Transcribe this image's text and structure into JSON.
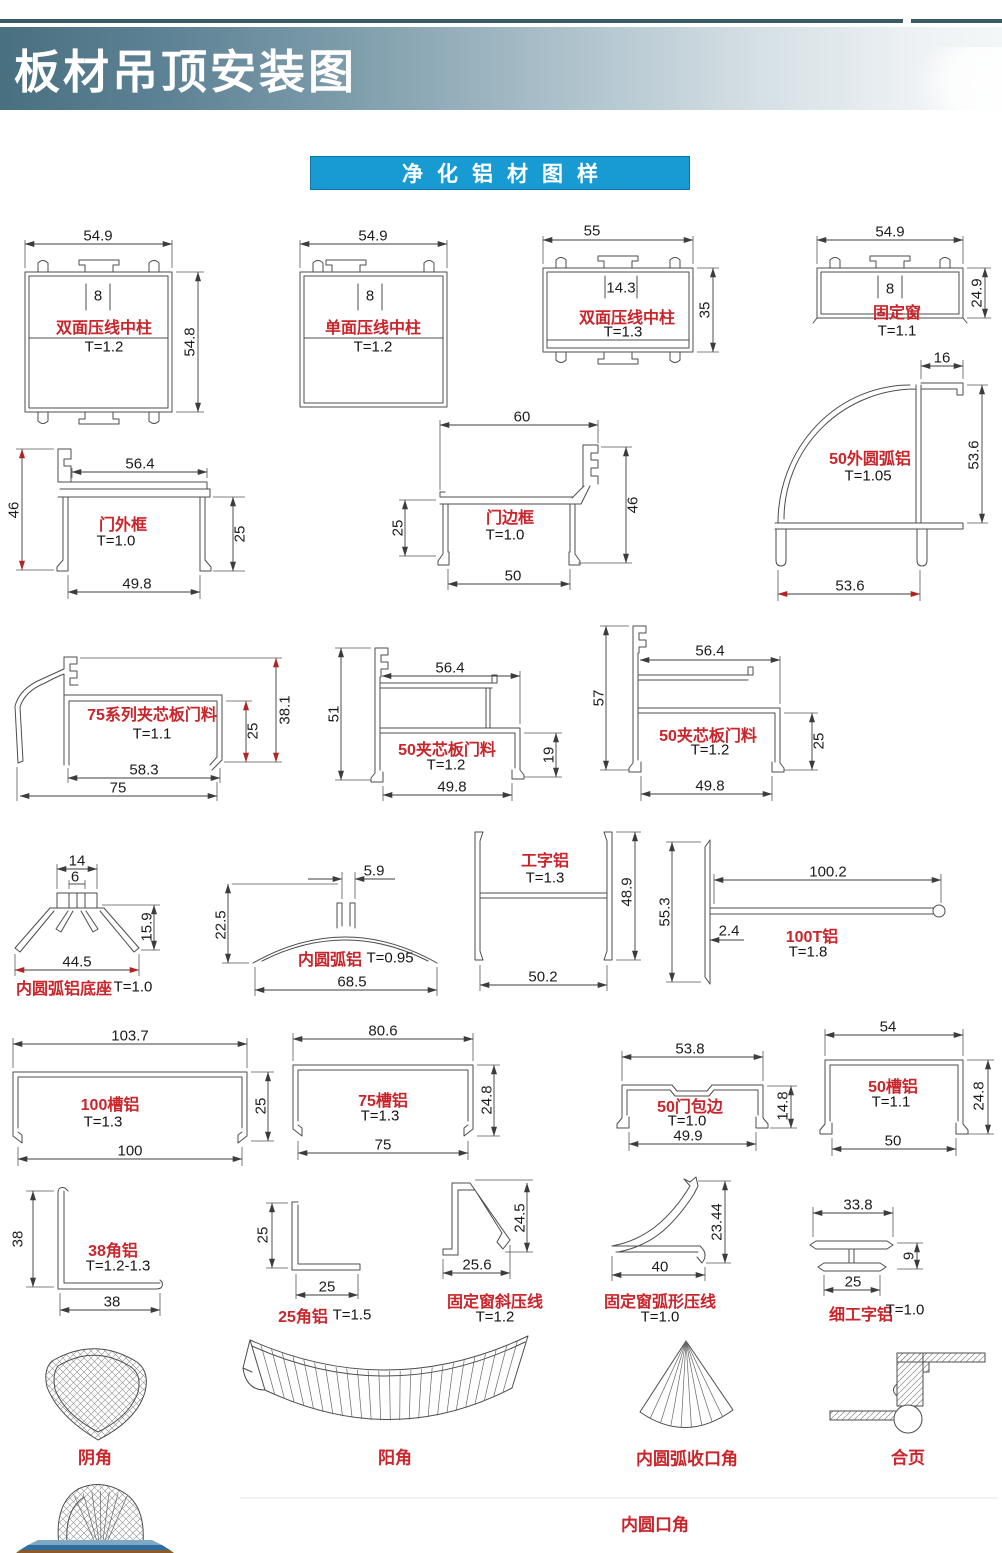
{
  "colors": {
    "banner_dark": "#49707f",
    "section_blue": "#189ad3",
    "label_red": "#c9252b"
  },
  "header": {
    "title": "板材吊顶安装图"
  },
  "section": {
    "title": "净化铝材图样"
  },
  "profiles": [
    {
      "name": "双面压线中柱",
      "t": "T=1.2",
      "dims": {
        "top": "54.9",
        "side": "54.8",
        "slot": "8"
      }
    },
    {
      "name": "单面压线中柱",
      "t": "T=1.2",
      "dims": {
        "top": "54.9",
        "slot": "8"
      }
    },
    {
      "name": "双面压线中柱",
      "t": "T=1.3",
      "dims": {
        "top": "55",
        "side": "35",
        "slot": "14.3"
      }
    },
    {
      "name": "固定窗",
      "t": "T=1.1",
      "dims": {
        "top": "54.9",
        "side": "24.9",
        "slot": "8"
      }
    },
    {
      "name": "门外框",
      "t": "T=1.0",
      "dims": {
        "top": "56.4",
        "left": "46",
        "right": "25",
        "bottom": "49.8"
      }
    },
    {
      "name": "门边框",
      "t": "T=1.0",
      "dims": {
        "top": "60",
        "left": "25",
        "right": "46",
        "bottom": "50"
      }
    },
    {
      "name": "50外圆弧铝",
      "t": "T=1.05",
      "dims": {
        "top": "16",
        "right": "53.6",
        "bottom": "53.6"
      }
    },
    {
      "name": "75系列夹芯板门料",
      "t": "T=1.1",
      "dims": {
        "right_inner": "25",
        "right_outer": "38.1",
        "bottom_inner": "58.3",
        "bottom_outer": "75"
      }
    },
    {
      "name": "50夹芯板门料",
      "t": "T=1.2",
      "dims": {
        "left": "51",
        "top": "56.4",
        "right": "19",
        "bottom": "49.8"
      }
    },
    {
      "name": "50夹芯板门料",
      "t": "T=1.2",
      "dims": {
        "left": "57",
        "top": "56.4",
        "right": "25",
        "bottom": "49.8"
      }
    },
    {
      "name": "内圆弧铝底座",
      "t": "T=1.0",
      "dims": {
        "top": "14",
        "slot": "6",
        "right": "15.9",
        "bottom": "44.5"
      }
    },
    {
      "name": "内圆弧铝",
      "t": "T=0.95",
      "dims": {
        "top": "5.9",
        "left": "22.5",
        "bottom": "68.5"
      }
    },
    {
      "name": "工字铝",
      "t": "T=1.3",
      "dims": {
        "right": "48.9",
        "bottom": "50.2"
      }
    },
    {
      "name": "100T铝",
      "t": "T=1.8",
      "dims": {
        "left": "55.3",
        "top": "100.2",
        "web": "2.4"
      }
    },
    {
      "name": "100槽铝",
      "t": "T=1.3",
      "dims": {
        "top": "103.7",
        "right": "25",
        "bottom": "100"
      }
    },
    {
      "name": "75槽铝",
      "t": "T=1.3",
      "dims": {
        "top": "80.6",
        "right": "24.8",
        "bottom": "75"
      }
    },
    {
      "name": "50门包边",
      "t": "T=1.0",
      "dims": {
        "top": "53.8",
        "right": "14.8",
        "bottom": "49.9"
      }
    },
    {
      "name": "50槽铝",
      "t": "T=1.1",
      "dims": {
        "top": "54",
        "right": "24.8",
        "bottom": "50"
      }
    },
    {
      "name": "38角铝",
      "t": "T=1.2-1.3",
      "dims": {
        "left": "38",
        "bottom": "38"
      }
    },
    {
      "name": "25角铝",
      "t": "T=1.5",
      "dims": {
        "left": "25",
        "bottom": "25"
      }
    },
    {
      "name": "固定窗斜压线",
      "t": "T=1.2",
      "dims": {
        "right": "24.5",
        "bottom": "25.6"
      }
    },
    {
      "name": "固定窗弧形压线",
      "t": "T=1.0",
      "dims": {
        "right": "23.44",
        "bottom": "40"
      }
    },
    {
      "name": "细工字铝",
      "t": "T=1.0",
      "dims": {
        "top": "33.8",
        "right": "9",
        "bottom": "25"
      }
    }
  ],
  "accessories": [
    {
      "name": "阴角"
    },
    {
      "name": "阳角"
    },
    {
      "name": "内圆弧收口角"
    },
    {
      "name": "合页"
    },
    {
      "name": "内圆口角"
    }
  ]
}
